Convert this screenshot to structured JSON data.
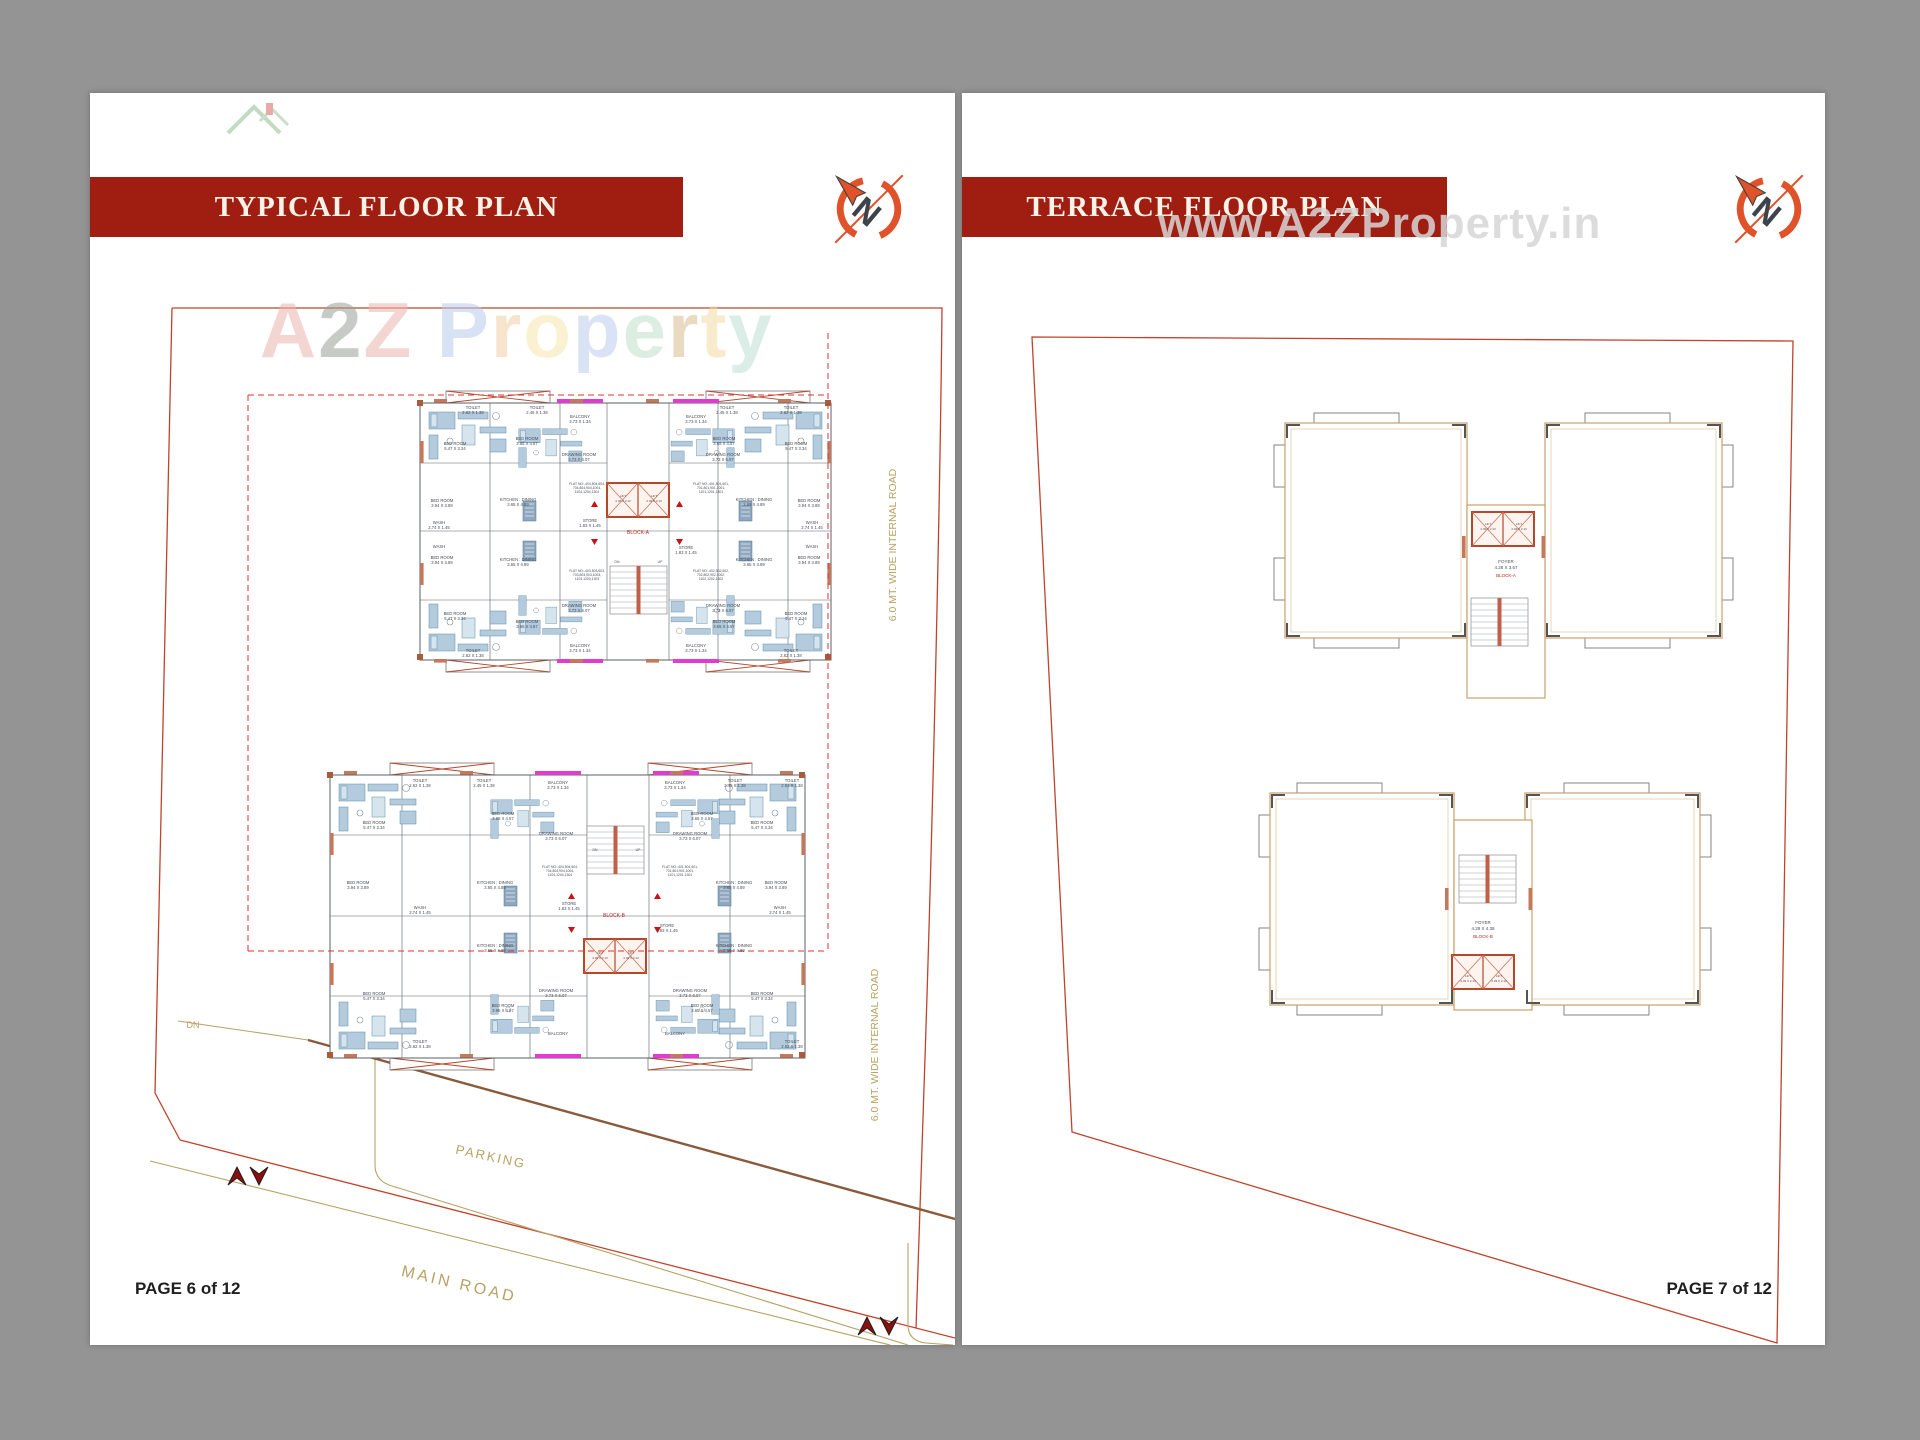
{
  "colors": {
    "banner": "#a01d12",
    "boundary": "#c0432b",
    "wall_orange": "#c4795b",
    "furniture_blue": "#b3cbdd",
    "balcony_magenta": "#e23bd0",
    "road_tan": "#b8a264",
    "background": "#949494",
    "watermark_gray": "#d6d6d6"
  },
  "compass_letter": "N",
  "left_page": {
    "banner_title": "TYPICAL FLOOR PLAN",
    "page_number": "PAGE 6 of 12",
    "watermark_letters": [
      {
        "ch": "A",
        "color": "#eab4ae"
      },
      {
        "ch": "2",
        "color": "#99a396"
      },
      {
        "ch": "Z",
        "color": "#eab4ae"
      },
      {
        "ch": " ",
        "color": "#ffffff"
      },
      {
        "ch": "P",
        "color": "#b7cdee"
      },
      {
        "ch": "r",
        "color": "#f4cda4"
      },
      {
        "ch": "o",
        "color": "#f7e5ae"
      },
      {
        "ch": "p",
        "color": "#bccdee"
      },
      {
        "ch": "e",
        "color": "#c0e1c9"
      },
      {
        "ch": "r",
        "color": "#d9bc92"
      },
      {
        "ch": "t",
        "color": "#f4dba2"
      },
      {
        "ch": "y",
        "color": "#bfe0d5"
      }
    ],
    "site_labels": [
      {
        "t": "DN",
        "x": 103,
        "y": 935,
        "s": 9,
        "c": "tan"
      },
      {
        "t": "PARKING",
        "x": 400,
        "y": 1068,
        "s": 13,
        "r": 12,
        "c": "tan",
        "ls": 2
      },
      {
        "t": "MAIN ROAD",
        "x": 368,
        "y": 1196,
        "s": 16,
        "r": 13,
        "c": "tan",
        "ls": 3
      },
      {
        "t": "6.0 MT. WIDE INTERNAL ROAD",
        "x": 806,
        "y": 452,
        "s": 10.5,
        "r": -90,
        "c": "tan"
      },
      {
        "t": "6.0 MT. WIDE INTERNAL ROAD",
        "x": 788,
        "y": 952,
        "s": 10.5,
        "r": -90,
        "c": "tan"
      }
    ],
    "plan_labels": [
      {
        "t": "TOILET",
        "x": 383,
        "y": 316
      },
      {
        "t": "2.62 X 1.38",
        "x": 383,
        "y": 321
      },
      {
        "t": "TOILET",
        "x": 447,
        "y": 316
      },
      {
        "t": "2.45 X 1.38",
        "x": 447,
        "y": 321
      },
      {
        "t": "TOILET",
        "x": 637,
        "y": 316
      },
      {
        "t": "2.45 X 1.38",
        "x": 637,
        "y": 321
      },
      {
        "t": "TOILET",
        "x": 701,
        "y": 316
      },
      {
        "t": "2.62 X 1.38",
        "x": 701,
        "y": 321
      },
      {
        "t": "TOILET",
        "x": 383,
        "y": 559
      },
      {
        "t": "2.62 X 1.38",
        "x": 383,
        "y": 564
      },
      {
        "t": "TOILET",
        "x": 701,
        "y": 559
      },
      {
        "t": "2.62 X 1.38",
        "x": 701,
        "y": 564
      },
      {
        "t": "BED ROOM",
        "x": 365,
        "y": 352
      },
      {
        "t": "5.47 X 3.34",
        "x": 365,
        "y": 357
      },
      {
        "t": "BED ROOM",
        "x": 706,
        "y": 352
      },
      {
        "t": "5.47 X 3.34",
        "x": 706,
        "y": 357
      },
      {
        "t": "BED ROOM",
        "x": 365,
        "y": 522
      },
      {
        "t": "5.47 X 3.34",
        "x": 365,
        "y": 527
      },
      {
        "t": "BED ROOM",
        "x": 706,
        "y": 522
      },
      {
        "t": "5.47 X 3.34",
        "x": 706,
        "y": 527
      },
      {
        "t": "BED ROOM",
        "x": 437,
        "y": 347
      },
      {
        "t": "3.65 X 4.57",
        "x": 437,
        "y": 352
      },
      {
        "t": "BED ROOM",
        "x": 634,
        "y": 347
      },
      {
        "t": "3.65 X 4.57",
        "x": 634,
        "y": 352
      },
      {
        "t": "BED ROOM",
        "x": 437,
        "y": 530
      },
      {
        "t": "3.65 X 4.57",
        "x": 437,
        "y": 535
      },
      {
        "t": "BED ROOM",
        "x": 634,
        "y": 530
      },
      {
        "t": "3.65 X 4.57",
        "x": 634,
        "y": 535
      },
      {
        "t": "BED ROOM",
        "x": 352,
        "y": 409
      },
      {
        "t": "3.94 X 3.89",
        "x": 352,
        "y": 414
      },
      {
        "t": "BED ROOM",
        "x": 719,
        "y": 409
      },
      {
        "t": "3.94 X 3.89",
        "x": 719,
        "y": 414
      },
      {
        "t": "BED ROOM",
        "x": 352,
        "y": 466
      },
      {
        "t": "3.94 X 3.89",
        "x": 352,
        "y": 471
      },
      {
        "t": "BED ROOM",
        "x": 719,
        "y": 466
      },
      {
        "t": "3.94 X 3.89",
        "x": 719,
        "y": 471
      },
      {
        "t": "DRAWING ROOM",
        "x": 489,
        "y": 363
      },
      {
        "t": "3.73 X 6.07",
        "x": 489,
        "y": 368
      },
      {
        "t": "DRAWING ROOM",
        "x": 633,
        "y": 363
      },
      {
        "t": "3.73 X 6.07",
        "x": 633,
        "y": 368
      },
      {
        "t": "DRAWING ROOM",
        "x": 489,
        "y": 514
      },
      {
        "t": "3.73 X 6.07",
        "x": 489,
        "y": 519
      },
      {
        "t": "DRAWING ROOM",
        "x": 633,
        "y": 514
      },
      {
        "t": "3.73 X 6.07",
        "x": 633,
        "y": 519
      },
      {
        "t": "KITCHEN : DINING",
        "x": 428,
        "y": 408
      },
      {
        "t": "3.65 X 4.89",
        "x": 428,
        "y": 413
      },
      {
        "t": "KITCHEN : DINING",
        "x": 664,
        "y": 408
      },
      {
        "t": "3.65 X 4.89",
        "x": 664,
        "y": 413
      },
      {
        "t": "KITCHEN : DINING",
        "x": 428,
        "y": 468
      },
      {
        "t": "3.65 X 4.89",
        "x": 428,
        "y": 473
      },
      {
        "t": "KITCHEN : DINING",
        "x": 664,
        "y": 468
      },
      {
        "t": "3.65 X 4.89",
        "x": 664,
        "y": 473
      },
      {
        "t": "WASH",
        "x": 349,
        "y": 431
      },
      {
        "t": "2.74 X 1.45",
        "x": 349,
        "y": 436
      },
      {
        "t": "WASH",
        "x": 722,
        "y": 431
      },
      {
        "t": "2.74 X 1.45",
        "x": 722,
        "y": 436
      },
      {
        "t": "WASH",
        "x": 349,
        "y": 455
      },
      {
        "t": "WASH",
        "x": 722,
        "y": 455
      },
      {
        "t": "STORE",
        "x": 500,
        "y": 429
      },
      {
        "t": "1.83 X 1.45",
        "x": 500,
        "y": 434
      },
      {
        "t": "STORE",
        "x": 596,
        "y": 456
      },
      {
        "t": "1.83 X 1.45",
        "x": 596,
        "y": 461
      },
      {
        "t": "FLAT NO:-404,504,604,",
        "x": 497,
        "y": 392,
        "s": 3.4
      },
      {
        "t": "704,804,904,1004,",
        "x": 497,
        "y": 396,
        "s": 3.4
      },
      {
        "t": "1104,1204,1304",
        "x": 497,
        "y": 400,
        "s": 3.4
      },
      {
        "t": "FLAT NO:-401,501,601,",
        "x": 621,
        "y": 392,
        "s": 3.4
      },
      {
        "t": "701,801,901,1001,",
        "x": 621,
        "y": 396,
        "s": 3.4
      },
      {
        "t": "1101,1201,1301",
        "x": 621,
        "y": 400,
        "s": 3.4
      },
      {
        "t": "FLAT NO:-403,503,603,",
        "x": 497,
        "y": 479,
        "s": 3.4
      },
      {
        "t": "703,803,903,1003,",
        "x": 497,
        "y": 483,
        "s": 3.4
      },
      {
        "t": "1103,1203,1303",
        "x": 497,
        "y": 487,
        "s": 3.4
      },
      {
        "t": "FLAT NO:-402,502,602,",
        "x": 621,
        "y": 479,
        "s": 3.4
      },
      {
        "t": "702,802,902,1002,",
        "x": 621,
        "y": 483,
        "s": 3.4
      },
      {
        "t": "1102,1202,1302",
        "x": 621,
        "y": 487,
        "s": 3.4
      },
      {
        "t": "BALCONY",
        "x": 490,
        "y": 325
      },
      {
        "t": "3.73 X 1.34",
        "x": 490,
        "y": 330
      },
      {
        "t": "BALCONY",
        "x": 606,
        "y": 325
      },
      {
        "t": "3.73 X 1.34",
        "x": 606,
        "y": 330
      },
      {
        "t": "BALCONY",
        "x": 490,
        "y": 554
      },
      {
        "t": "3.73 X 1.34",
        "x": 490,
        "y": 559
      },
      {
        "t": "BALCONY",
        "x": 606,
        "y": 554
      },
      {
        "t": "3.73 X 1.34",
        "x": 606,
        "y": 559
      },
      {
        "t": "LIFT",
        "x": 533,
        "y": 404,
        "s": 3
      },
      {
        "t": "2.03 X 2.13",
        "x": 533,
        "y": 409,
        "s": 3
      },
      {
        "t": "LIFT",
        "x": 564,
        "y": 404,
        "s": 3
      },
      {
        "t": "2.03 X 2.13",
        "x": 564,
        "y": 409,
        "s": 3
      },
      {
        "t": "BLOCK-A",
        "x": 548,
        "y": 441,
        "c": "red",
        "s": 5
      },
      {
        "t": "DN",
        "x": 527,
        "y": 470,
        "s": 3.4
      },
      {
        "t": "UP",
        "x": 570,
        "y": 470,
        "s": 3.4
      },
      {
        "t": "TOILET",
        "x": 330,
        "y": 689
      },
      {
        "t": "2.62 X 1.38",
        "x": 330,
        "y": 694
      },
      {
        "t": "TOILET",
        "x": 394,
        "y": 689
      },
      {
        "t": "2.45 X 1.38",
        "x": 394,
        "y": 694
      },
      {
        "t": "TOILET",
        "x": 645,
        "y": 689
      },
      {
        "t": "2.45 X 1.38",
        "x": 645,
        "y": 694
      },
      {
        "t": "TOILET",
        "x": 702,
        "y": 689
      },
      {
        "t": "2.62 X 1.38",
        "x": 702,
        "y": 694
      },
      {
        "t": "TOILET",
        "x": 330,
        "y": 950
      },
      {
        "t": "2.62 X 1.38",
        "x": 330,
        "y": 955
      },
      {
        "t": "TOILET",
        "x": 702,
        "y": 950
      },
      {
        "t": "2.62 X 1.38",
        "x": 702,
        "y": 955
      },
      {
        "t": "BED ROOM",
        "x": 284,
        "y": 731
      },
      {
        "t": "5.47 X 3.34",
        "x": 284,
        "y": 736
      },
      {
        "t": "BED ROOM",
        "x": 672,
        "y": 731
      },
      {
        "t": "5.47 X 3.34",
        "x": 672,
        "y": 736
      },
      {
        "t": "BED ROOM",
        "x": 284,
        "y": 902
      },
      {
        "t": "5.47 X 3.34",
        "x": 284,
        "y": 907
      },
      {
        "t": "BED ROOM",
        "x": 672,
        "y": 902
      },
      {
        "t": "5.47 X 3.34",
        "x": 672,
        "y": 907
      },
      {
        "t": "BED ROOM",
        "x": 413,
        "y": 722
      },
      {
        "t": "3.65 X 4.57",
        "x": 413,
        "y": 727
      },
      {
        "t": "BED ROOM",
        "x": 612,
        "y": 722
      },
      {
        "t": "3.65 X 4.57",
        "x": 612,
        "y": 727
      },
      {
        "t": "BED ROOM",
        "x": 413,
        "y": 914
      },
      {
        "t": "3.65 X 4.57",
        "x": 413,
        "y": 919
      },
      {
        "t": "BED ROOM",
        "x": 612,
        "y": 914
      },
      {
        "t": "3.65 X 4.57",
        "x": 612,
        "y": 919
      },
      {
        "t": "BED ROOM",
        "x": 268,
        "y": 791
      },
      {
        "t": "3.94 X 3.89",
        "x": 268,
        "y": 796
      },
      {
        "t": "BED ROOM",
        "x": 686,
        "y": 791
      },
      {
        "t": "3.94 X 3.89",
        "x": 686,
        "y": 796
      },
      {
        "t": "DRAWING ROOM",
        "x": 466,
        "y": 742
      },
      {
        "t": "3.73 X 6.07",
        "x": 466,
        "y": 747
      },
      {
        "t": "DRAWING ROOM",
        "x": 600,
        "y": 742
      },
      {
        "t": "3.73 X 6.07",
        "x": 600,
        "y": 747
      },
      {
        "t": "DRAWING ROOM",
        "x": 466,
        "y": 899
      },
      {
        "t": "3.73 X 6.07",
        "x": 466,
        "y": 904
      },
      {
        "t": "DRAWING ROOM",
        "x": 600,
        "y": 899
      },
      {
        "t": "3.73 X 6.07",
        "x": 600,
        "y": 904
      },
      {
        "t": "KITCHEN : DINING",
        "x": 405,
        "y": 791
      },
      {
        "t": "3.65 X 4.89",
        "x": 405,
        "y": 796
      },
      {
        "t": "KITCHEN : DINING",
        "x": 644,
        "y": 791
      },
      {
        "t": "3.65 X 4.89",
        "x": 644,
        "y": 796
      },
      {
        "t": "KITCHEN : DINING",
        "x": 405,
        "y": 854
      },
      {
        "t": "3.65 X 4.89",
        "x": 405,
        "y": 859
      },
      {
        "t": "KITCHEN : DINING",
        "x": 644,
        "y": 854
      },
      {
        "t": "3.65 X 4.89",
        "x": 644,
        "y": 859
      },
      {
        "t": "WASH",
        "x": 330,
        "y": 816
      },
      {
        "t": "2.74 X 1.45",
        "x": 330,
        "y": 821
      },
      {
        "t": "WASH",
        "x": 690,
        "y": 816
      },
      {
        "t": "2.74 X 1.45",
        "x": 690,
        "y": 821
      },
      {
        "t": "STORE",
        "x": 479,
        "y": 812
      },
      {
        "t": "1.83 X 1.45",
        "x": 479,
        "y": 817
      },
      {
        "t": "STORE",
        "x": 577,
        "y": 834
      },
      {
        "t": "1.83 X 1.45",
        "x": 577,
        "y": 839
      },
      {
        "t": "FLAT NO:-404,504,604,",
        "x": 470,
        "y": 775,
        "s": 3.4
      },
      {
        "t": "704,804,904,1004,",
        "x": 470,
        "y": 779,
        "s": 3.4
      },
      {
        "t": "1104,1204,1304",
        "x": 470,
        "y": 783,
        "s": 3.4
      },
      {
        "t": "FLAT NO:-401,501,601,",
        "x": 590,
        "y": 775,
        "s": 3.4
      },
      {
        "t": "701,801,901,1001,",
        "x": 590,
        "y": 779,
        "s": 3.4
      },
      {
        "t": "1101,1201,1301",
        "x": 590,
        "y": 783,
        "s": 3.4
      },
      {
        "t": "BALCONY",
        "x": 468,
        "y": 691
      },
      {
        "t": "3.73 X 1.34",
        "x": 468,
        "y": 696
      },
      {
        "t": "BALCONY",
        "x": 585,
        "y": 691
      },
      {
        "t": "3.73 X 1.34",
        "x": 585,
        "y": 696
      },
      {
        "t": "BALCONY",
        "x": 468,
        "y": 942
      },
      {
        "t": "BALCONY",
        "x": 585,
        "y": 942
      },
      {
        "t": "LIFT",
        "x": 510,
        "y": 861,
        "s": 3
      },
      {
        "t": "2.03 X 2.13",
        "x": 510,
        "y": 866,
        "s": 3
      },
      {
        "t": "LIFT",
        "x": 541,
        "y": 861,
        "s": 3
      },
      {
        "t": "2.03 X 2.13",
        "x": 541,
        "y": 866,
        "s": 3
      },
      {
        "t": "BLOCK-B",
        "x": 524,
        "y": 824,
        "c": "red",
        "s": 5
      },
      {
        "t": "DN",
        "x": 505,
        "y": 758,
        "s": 3.4
      },
      {
        "t": "UP",
        "x": 548,
        "y": 758,
        "s": 3.4
      }
    ]
  },
  "right_page": {
    "banner_title": "TERRACE FLOOR PLAN",
    "watermark_url": "www.A2ZProperty.in",
    "page_number": "PAGE 7 of 12",
    "plan_labels": [
      {
        "t": "FOYER",
        "x": 544,
        "y": 470,
        "s": 4.5
      },
      {
        "t": "4.28 X 3.67",
        "x": 544,
        "y": 476,
        "s": 4.5
      },
      {
        "t": "BLOCK-A",
        "x": 544,
        "y": 484,
        "c": "red",
        "s": 4.5
      },
      {
        "t": "LIFT",
        "x": 526,
        "y": 432,
        "s": 3
      },
      {
        "t": "2.03 X 2.13",
        "x": 526,
        "y": 437,
        "s": 3
      },
      {
        "t": "LIFT",
        "x": 557,
        "y": 432,
        "s": 3
      },
      {
        "t": "2.03 X 2.13",
        "x": 557,
        "y": 437,
        "s": 3
      },
      {
        "t": "FOYER",
        "x": 521,
        "y": 831,
        "s": 4.5
      },
      {
        "t": "4.28 X 4.38",
        "x": 521,
        "y": 837,
        "s": 4.5
      },
      {
        "t": "BLOCK-B",
        "x": 521,
        "y": 845,
        "c": "red",
        "s": 4.5
      },
      {
        "t": "LIFT",
        "x": 506,
        "y": 884,
        "s": 3
      },
      {
        "t": "2.03 X 2.13",
        "x": 506,
        "y": 889,
        "s": 3
      },
      {
        "t": "LIFT",
        "x": 537,
        "y": 884,
        "s": 3
      },
      {
        "t": "2.03 X 2.13",
        "x": 537,
        "y": 889,
        "s": 3
      }
    ]
  }
}
